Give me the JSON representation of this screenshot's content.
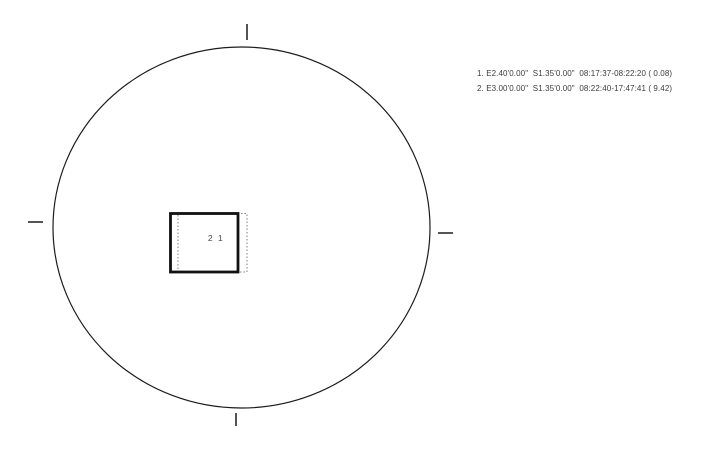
{
  "diagram": {
    "type": "sun-shading-plot",
    "center_label": "2 1",
    "legend_entries": [
      "1. E2.40'0.00\"  S1.35'0.00\"  08:17:37-08:22:20 ( 0.08)",
      "2. E3.00'0.00\"  S1.35'0.00\"  08:22:40-17:47:41 ( 9.42)"
    ],
    "colors": {
      "line": "#1c1c1c",
      "square_border": "#111111",
      "dotted_outline": "#7f7f7f",
      "legend_text": "#3d3d3d",
      "center_label_text": "#4a4a4a",
      "background": "#ffffff"
    }
  }
}
